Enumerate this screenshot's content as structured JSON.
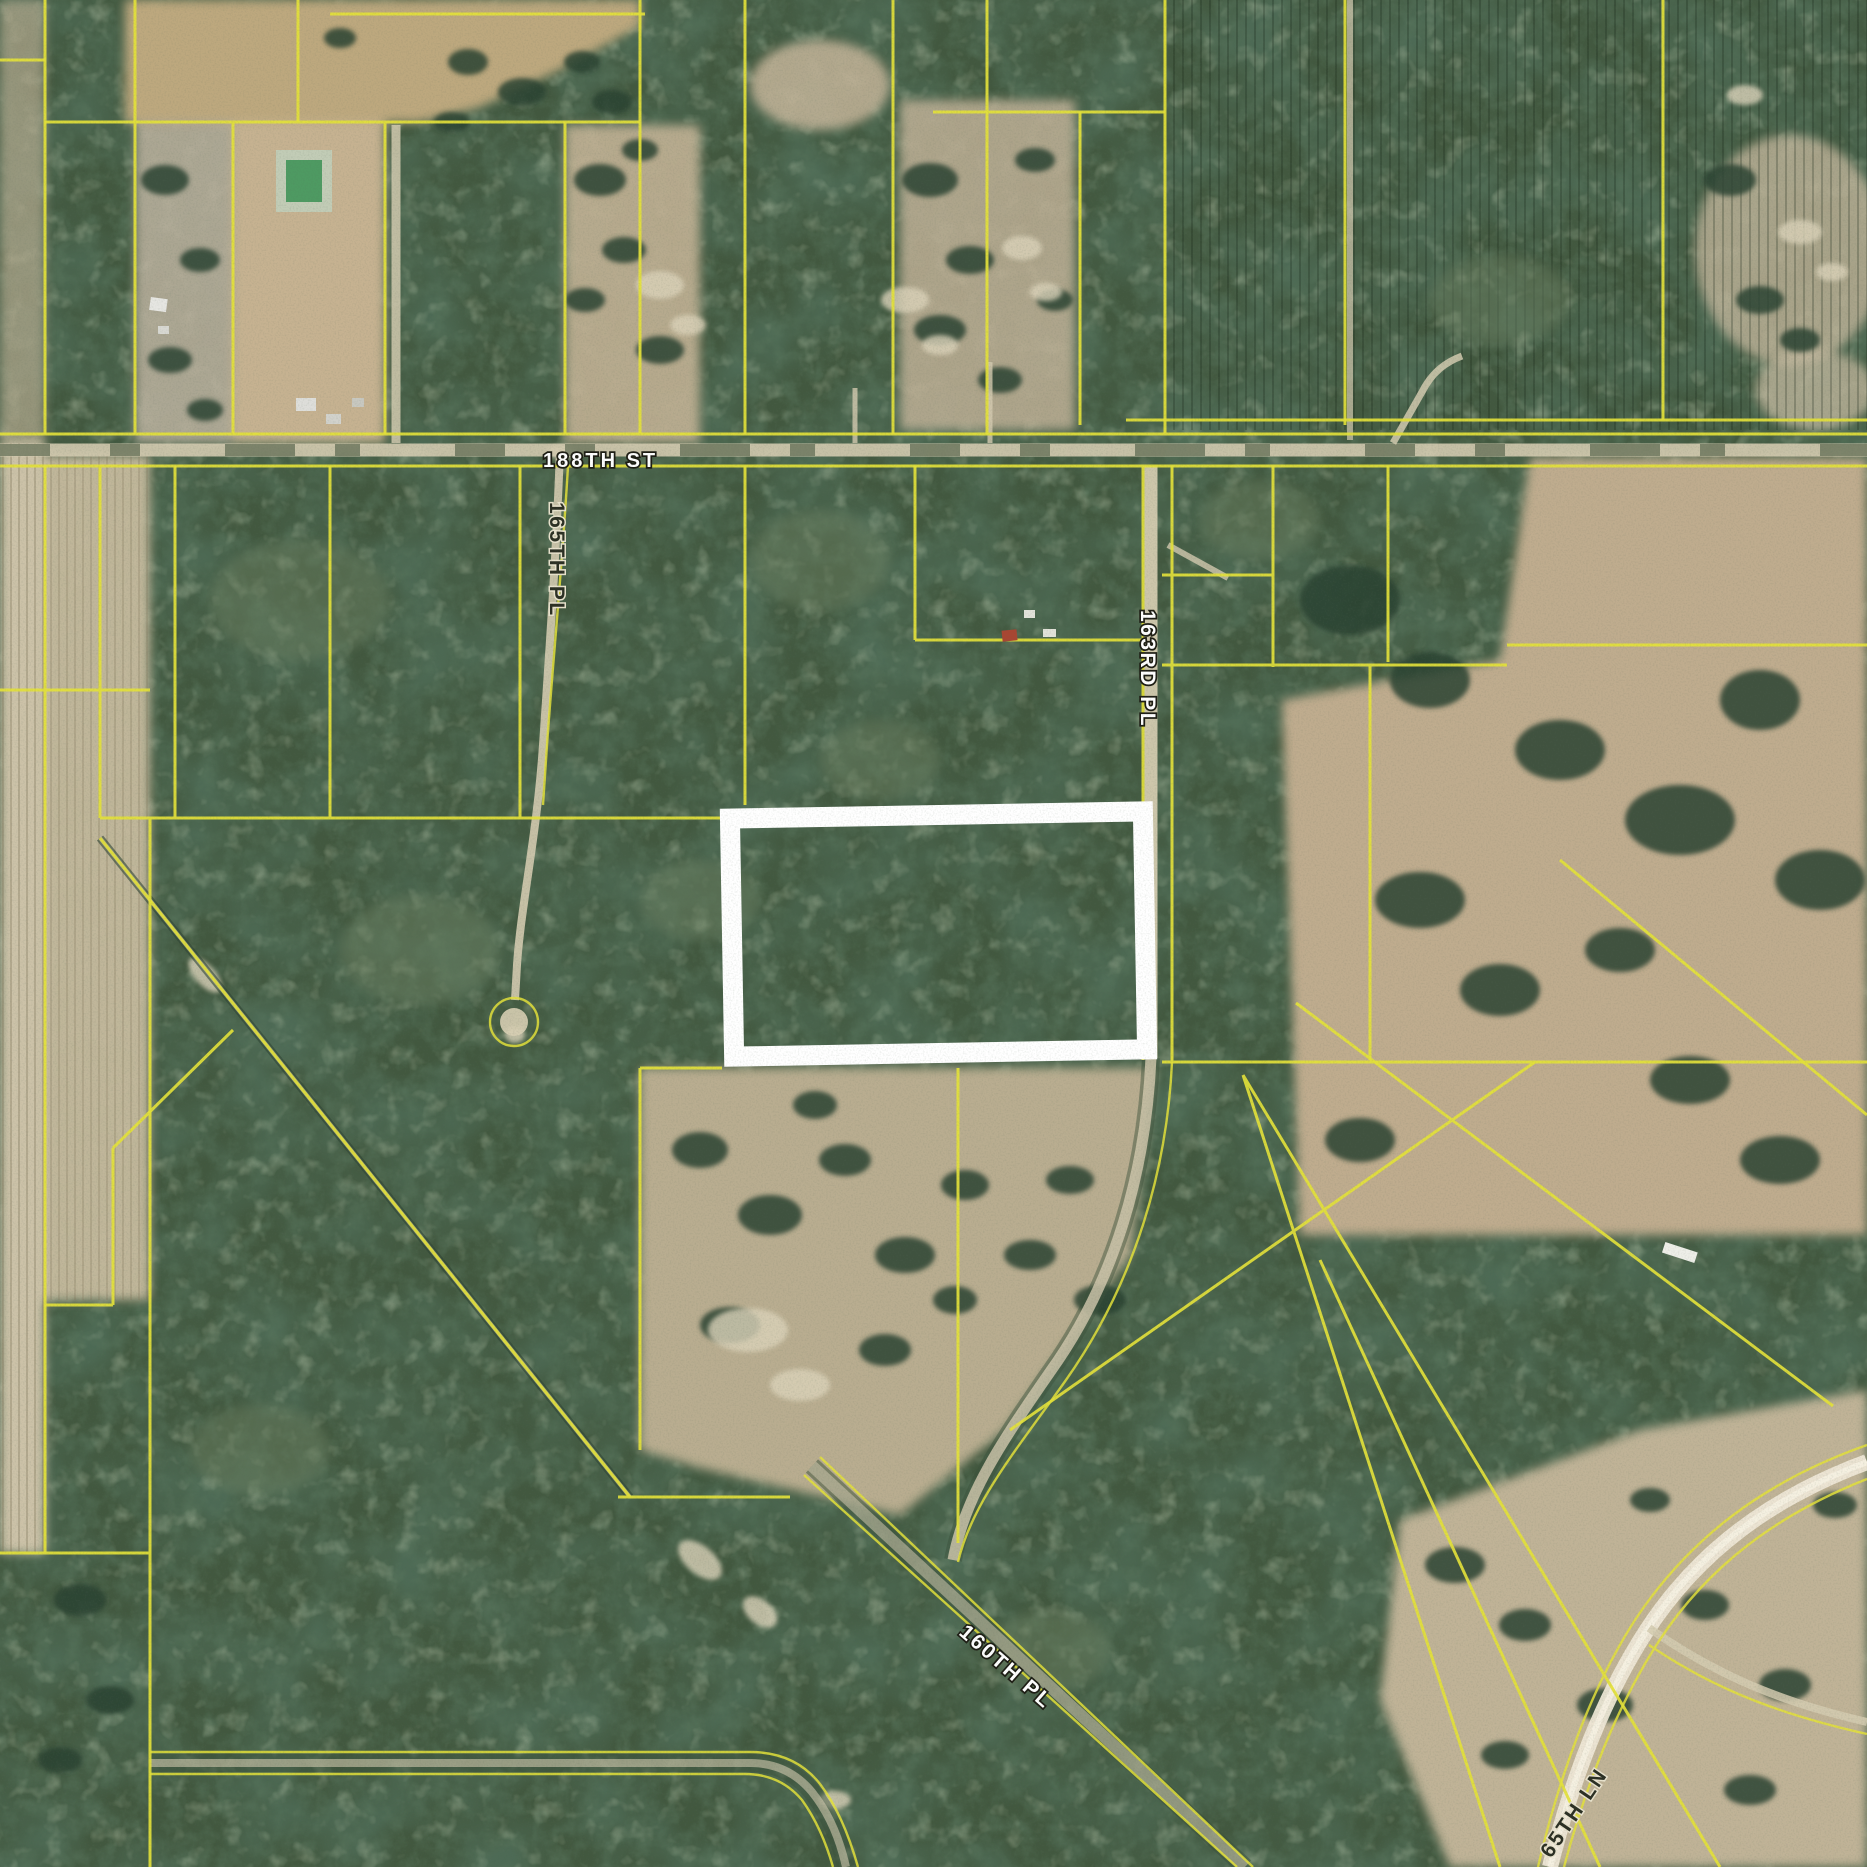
{
  "map": {
    "type": "aerial-parcel-map",
    "description": "Satellite aerial view with yellow parcel boundary lines and a white-outlined subject parcel",
    "highlight_parcel": {
      "x": "732",
      "y": "815",
      "width": "413",
      "height": "238",
      "stroke_width": "20"
    },
    "colors": {
      "parcel_line": "#e3e13a",
      "highlight": "#ffffff",
      "forest": "#42583f",
      "field": "#c3b094",
      "road": "#d4cbb0"
    },
    "road_labels": [
      {
        "text": "188TH ST",
        "transform": "translate(543,467)",
        "style": "light"
      },
      {
        "text": "165TH PL",
        "transform": "translate(550,502) rotate(90)",
        "style": "dark"
      },
      {
        "text": "163RD PL",
        "transform": "translate(1141,610) rotate(90)",
        "style": "light"
      },
      {
        "text": "160TH PL",
        "transform": "translate(958,1634) rotate(41)",
        "style": "light"
      },
      {
        "text": "65TH LN",
        "transform": "translate(1551,1859) rotate(-56)",
        "style": "dark"
      }
    ]
  }
}
